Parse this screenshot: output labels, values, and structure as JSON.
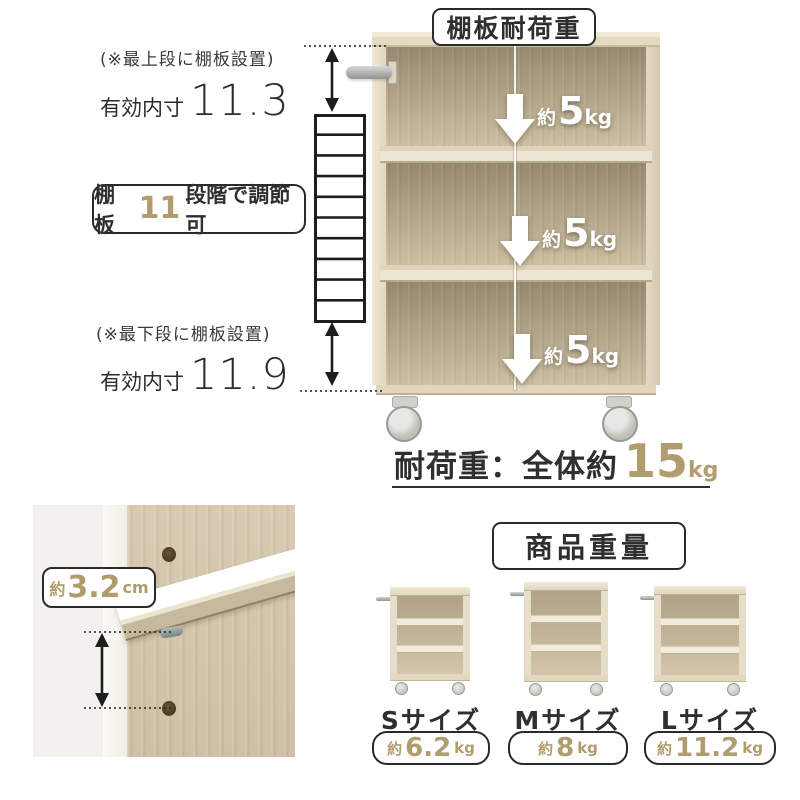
{
  "colors": {
    "accent_gold": "#b19c6d",
    "text_dark": "#2f2f2f"
  },
  "shelf_load": {
    "title": "棚板耐荷重",
    "arrows": [
      {
        "approx": "約",
        "value": "5",
        "unit": "kg"
      },
      {
        "approx": "約",
        "value": "5",
        "unit": "kg"
      },
      {
        "approx": "約",
        "value": "5",
        "unit": "kg"
      }
    ],
    "total": {
      "label": "耐荷重：全体約",
      "value": "15",
      "unit": "kg"
    }
  },
  "left_annotations": {
    "top_note": "(※最上段に棚板設置)",
    "top_inner": {
      "label": "有効内寸",
      "value": "11.3"
    },
    "adjust": {
      "prefix": "棚板",
      "count": "11",
      "suffix": "段階で調節可"
    },
    "bottom_note": "(※最下段に棚板設置)",
    "bottom_inner": {
      "label": "有効内寸",
      "value": "11.9"
    }
  },
  "thickness_detail": {
    "approx": "約",
    "value": "3.2",
    "unit": "cm"
  },
  "product_weight": {
    "title": "商品重量",
    "items": [
      {
        "size": "Sサイズ",
        "approx": "約",
        "value": "6.2",
        "unit": "kg"
      },
      {
        "size": "Mサイズ",
        "approx": "約",
        "value": "8",
        "unit": "kg"
      },
      {
        "size": "Lサイズ",
        "approx": "約",
        "value": "11.2",
        "unit": "kg"
      }
    ]
  }
}
